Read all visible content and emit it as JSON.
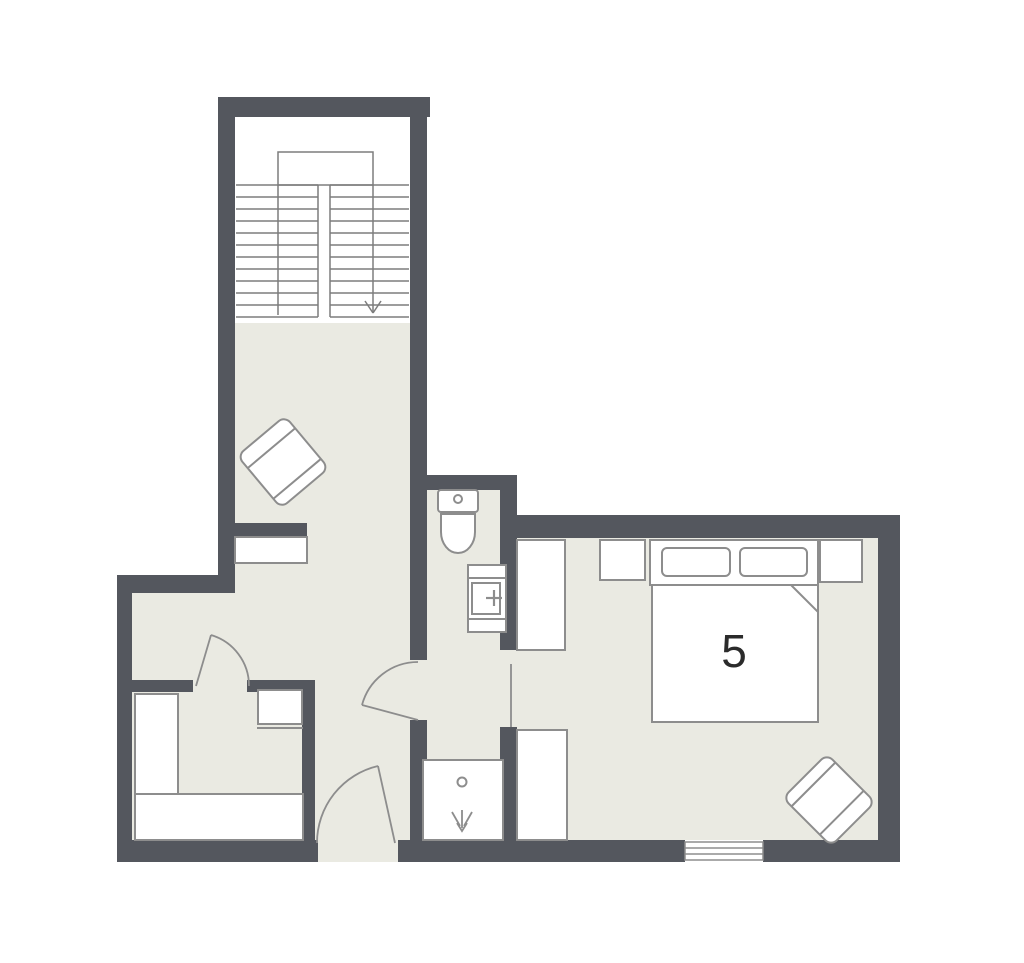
{
  "floorplan": {
    "room_label": "5",
    "colors": {
      "wall": "#54575e",
      "floor": "#eaeae2",
      "stair_area": "#ffffff",
      "furniture_fill": "#ffffff",
      "furniture_outline": "#8d8d8d",
      "stair_line": "#7d7d7d",
      "label_text": "#2b2b2b",
      "background": "#ffffff"
    },
    "icons": {
      "stairs_direction_icon": "down-arrow",
      "shower_head_icon": "trident-down-arrow",
      "toilet_icon": "tank-with-button-and-bowl",
      "sink_icon": "basin-with-faucet-cross",
      "toilet_button_icon": "dot",
      "shower_drain_icon": "dot"
    }
  }
}
